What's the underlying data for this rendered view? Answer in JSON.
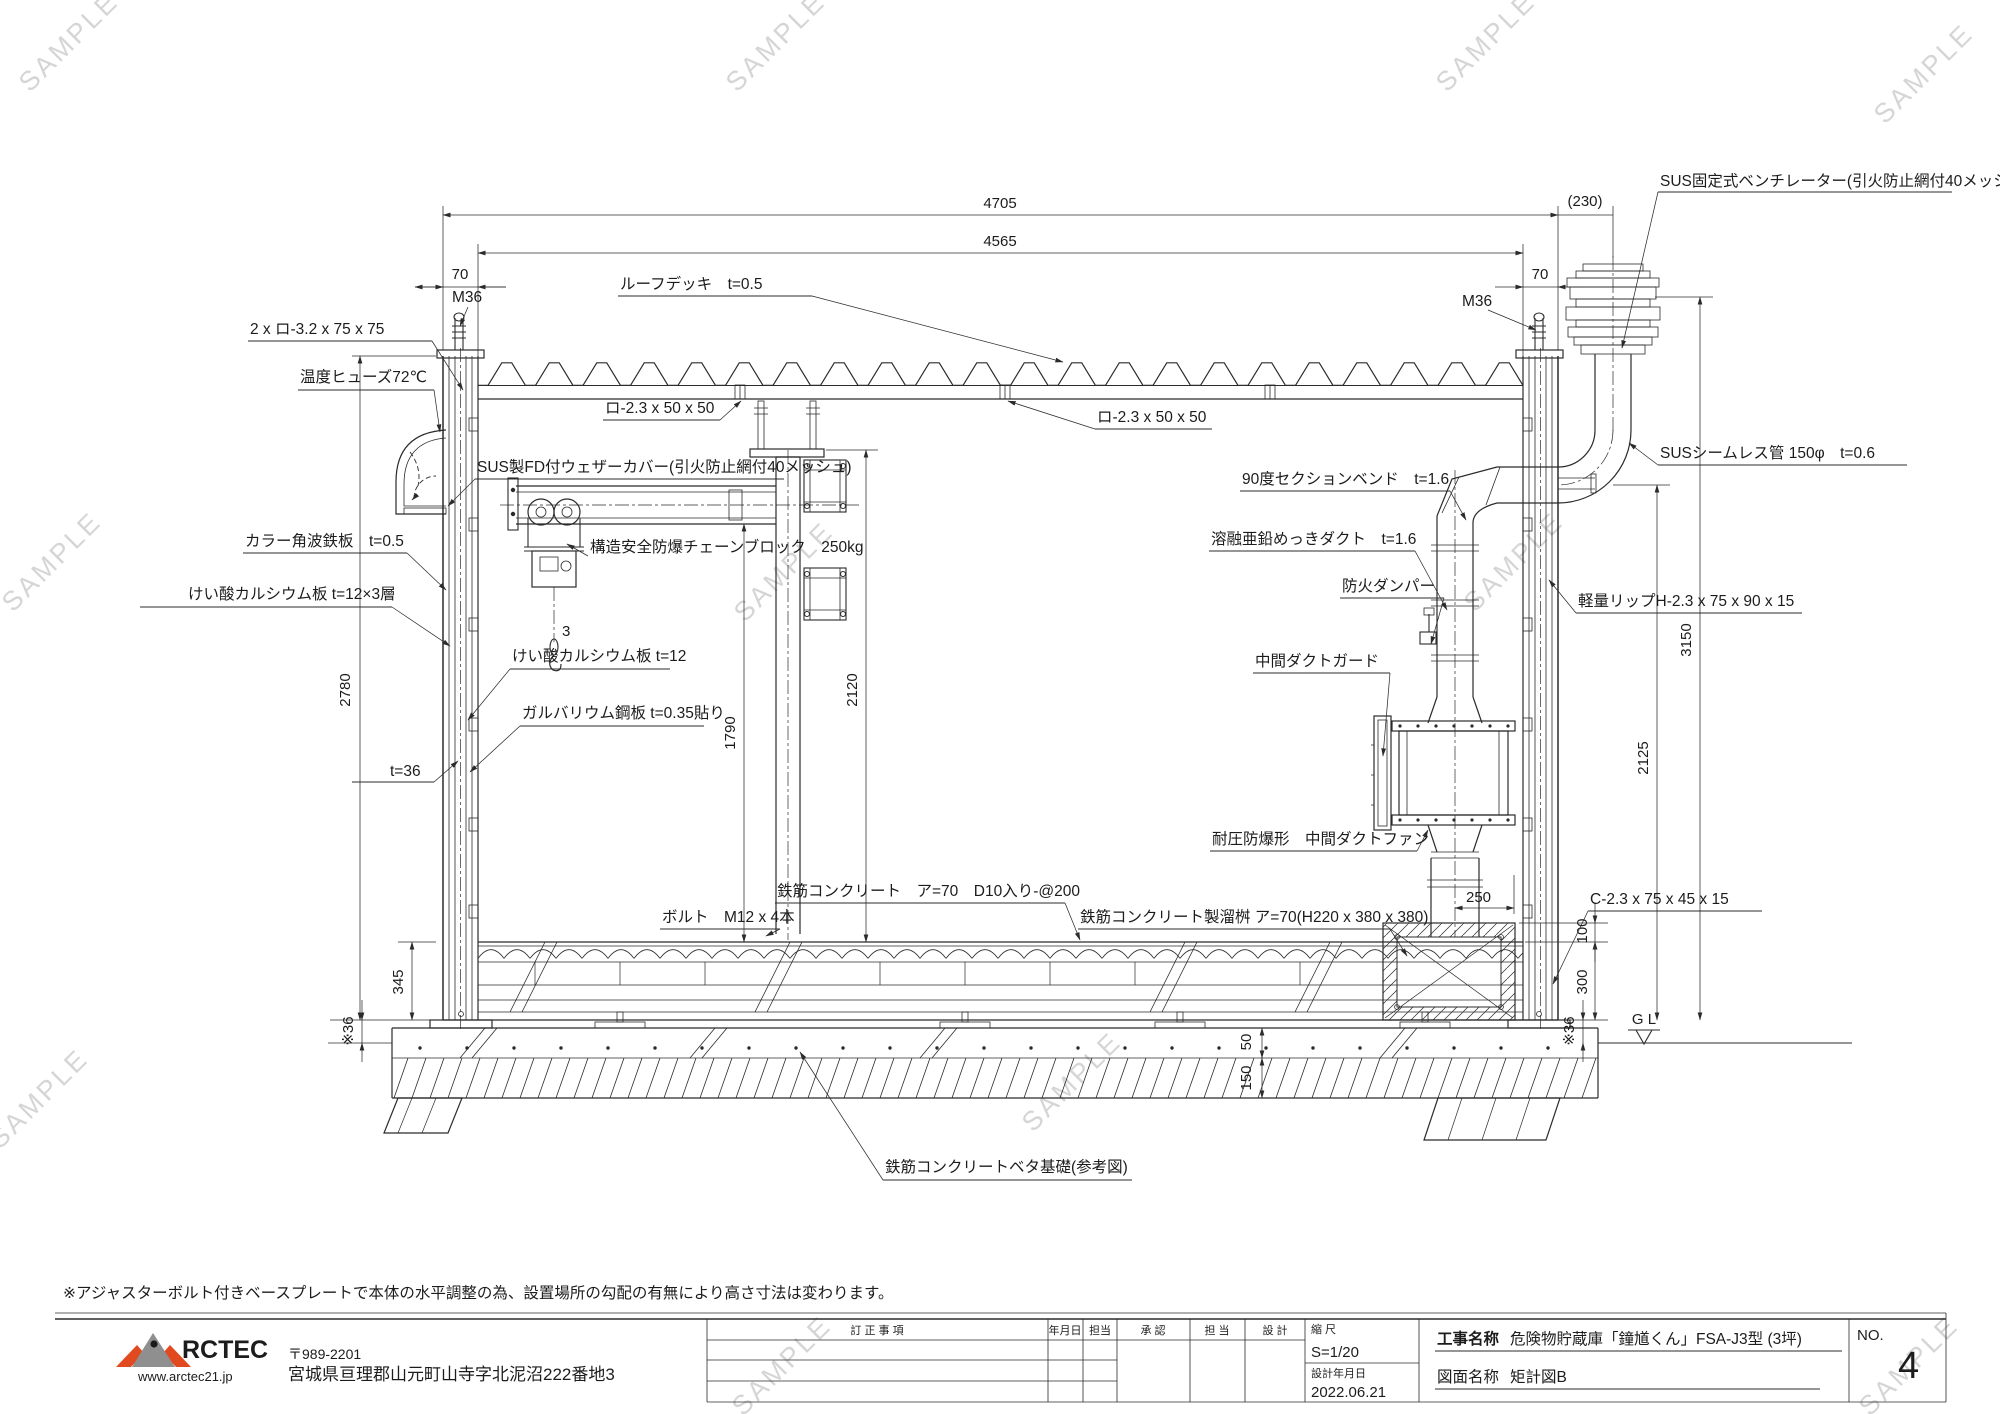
{
  "watermark": "SAMPLE",
  "note": "※アジャスターボルト付きベースプレートで本体の水平調整の為、設置場所の勾配の有無により高さ寸法は変わります。",
  "drawing": {
    "labels": {
      "ventilator": "SUS固定式ベンチレーター(引火防止網付40メッシュ)",
      "roof_deck": "ルーフデッキ　t=0.5",
      "frame2x": "2 x ロ-3.2 x 75 x 75",
      "temp_fuse": "温度ヒューズ72℃",
      "clip": "ロ-2.3 x 50 x 50",
      "weather_cover": "SUS製FD付ウェザーカバー(引火防止網付40メッシュ)",
      "chain_block": "構造安全防爆チェーンブロック　250kg",
      "color_sheet": "カラー角波鉄板　t=0.5",
      "calcium3": "けい酸カルシウム板 t=12×3層",
      "calcium1": "けい酸カルシウム板 t=12",
      "galvalume": "ガルバリウム鋼板 t=0.35貼り",
      "t36": "t=36",
      "bend90": "90度セクションベンド　t=1.6",
      "zinc_duct": "溶融亜鉛めっきダクト　t=1.6",
      "fire_damper": "防火ダンパー",
      "duct_guard": "中間ダクトガード",
      "light_lip": "軽量リップH-2.3 x 75 x 90 x 15",
      "duct_fan": "耐圧防爆形　中間ダクトファン",
      "seamless": "SUSシームレス管 150φ　t=0.6",
      "c_channel": "C-2.3 x 75 x 45 x 15",
      "rc_slab": "鉄筋コンクリート　ア=70　D10入り-@200",
      "bolt": "ボルト　M12 x 4本",
      "rc_pit": "鉄筋コンクリート製溜桝 ア=70(H220 x 380 x 380)",
      "rc_found": "鉄筋コンクリートベタ基礎(参考図)",
      "m36": "M36",
      "chain_falls": "3"
    },
    "dims": {
      "d4705": "4705",
      "d4565": "4565",
      "d70": "70",
      "d230": "(230)",
      "d2780": "2780",
      "d345": "345",
      "dstar36": "※36",
      "d2120": "2120",
      "d1790": "1790",
      "d3150": "3150",
      "d2125": "2125",
      "d100": "100",
      "d300": "300",
      "d50": "50",
      "d150": "150",
      "d250": "250",
      "gl": "G L"
    }
  },
  "title_block": {
    "revision_header": "訂 正 事 項",
    "date_col": "年月日",
    "staff_col": "担当",
    "approval_col": "承  認",
    "staff2_col": "担  当",
    "design_col": "設  計",
    "scale_label": "縮  尺",
    "scale_value": "S=1/20",
    "design_date_label": "設計年月日",
    "design_date_value": "2022.06.21",
    "project_label": "工事名称",
    "project_value": "危険物貯蔵庫「鐘馗くん」FSA-J3型 (3坪)",
    "sheet_label": "図面名称",
    "sheet_value": "矩計図B",
    "no_label": "NO.",
    "no_value": "4"
  },
  "company": {
    "name": "RCTEC",
    "url": "www.arctec21.jp",
    "postal": "〒989-2201",
    "address": "宮城県亘理郡山元町山寺字北泥沼222番地3"
  }
}
